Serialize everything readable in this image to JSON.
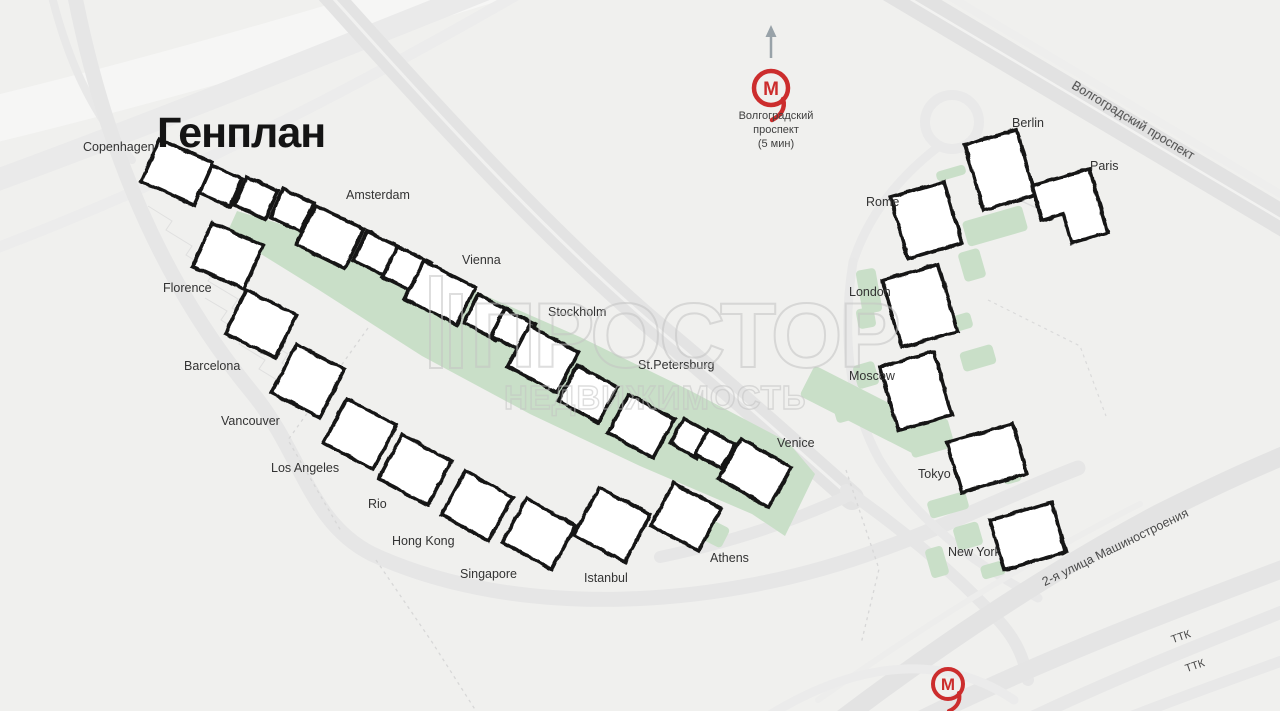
{
  "title": "Генплан",
  "watermark": {
    "line1": "ПРОСТОР",
    "line2": "НЕДВИЖИМОСТЬ"
  },
  "metro": {
    "top": {
      "caption_lines": [
        "Волгоградский",
        "проспект",
        "(5 мин)"
      ],
      "cx": 771,
      "cy": 88
    },
    "bottom": {
      "cx": 948,
      "cy": 684
    },
    "letter": "М"
  },
  "streets": [
    {
      "name": "Волгоградский проспект"
    },
    {
      "name": "2-я улица Машиностроения"
    },
    {
      "name": "ТТК"
    },
    {
      "name": "ТТК"
    }
  ],
  "colors": {
    "background": "#f0f0ee",
    "road": "#e3e3e3",
    "green": "#c9dfc8",
    "building_fill": "#ffffff",
    "building_stroke": "#151515",
    "metro_red": "#cc2d2d",
    "watermark": "#c3c3c3"
  },
  "map": {
    "courtyard_points": "237,211 355,246 468,288 580,337 689,390 788,442 815,474 785,536 752,514 640,466 530,414 422,356 319,290 227,233",
    "green_patches": [
      {
        "cx": 995,
        "cy": 226,
        "w": 62,
        "h": 26,
        "rot": -16
      },
      {
        "cx": 972,
        "cy": 265,
        "w": 22,
        "h": 30,
        "rot": -16
      },
      {
        "cx": 869,
        "cy": 291,
        "w": 20,
        "h": 44,
        "rot": -10
      },
      {
        "cx": 866,
        "cy": 318,
        "w": 18,
        "h": 20,
        "rot": -10
      },
      {
        "cx": 962,
        "cy": 322,
        "w": 20,
        "h": 16,
        "rot": -16
      },
      {
        "cx": 978,
        "cy": 358,
        "w": 34,
        "h": 20,
        "rot": -16
      },
      {
        "cx": 866,
        "cy": 375,
        "w": 22,
        "h": 24,
        "rot": -16
      },
      {
        "cx": 845,
        "cy": 406,
        "w": 24,
        "h": 30,
        "rot": -16
      },
      {
        "cx": 865,
        "cy": 410,
        "w": 130,
        "h": 34,
        "rot": 27
      },
      {
        "cx": 930,
        "cy": 438,
        "w": 44,
        "h": 30,
        "rot": -16
      },
      {
        "cx": 948,
        "cy": 505,
        "w": 40,
        "h": 18,
        "rot": -16
      },
      {
        "cx": 968,
        "cy": 536,
        "w": 26,
        "h": 24,
        "rot": -16
      },
      {
        "cx": 1012,
        "cy": 477,
        "w": 18,
        "h": 12,
        "rot": -16
      },
      {
        "cx": 937,
        "cy": 562,
        "w": 18,
        "h": 30,
        "rot": -16
      },
      {
        "cx": 993,
        "cy": 570,
        "w": 24,
        "h": 14,
        "rot": -16
      },
      {
        "cx": 893,
        "cy": 427,
        "w": 16,
        "h": 18,
        "rot": -16
      },
      {
        "cx": 951,
        "cy": 173,
        "w": 30,
        "h": 10,
        "rot": -16
      },
      {
        "cx": 597,
        "cy": 416,
        "w": 16,
        "h": 30,
        "rot": 27
      },
      {
        "cx": 686,
        "cy": 462,
        "w": 36,
        "h": 18,
        "rot": 27
      },
      {
        "cx": 714,
        "cy": 533,
        "w": 26,
        "h": 22,
        "rot": 27
      },
      {
        "cx": 352,
        "cy": 264,
        "w": 32,
        "h": 22,
        "rot": 26
      },
      {
        "cx": 588,
        "cy": 356,
        "w": 34,
        "h": 24,
        "rot": 26
      },
      {
        "cx": 700,
        "cy": 424,
        "w": 30,
        "h": 22,
        "rot": 26
      }
    ],
    "buildings": [
      {
        "label": "Copenhagen",
        "lx": 83,
        "ly": 151,
        "cx": 177,
        "cy": 172,
        "w": 58,
        "h": 46,
        "rot": 24
      },
      {
        "cx": 221,
        "cy": 186,
        "w": 33,
        "h": 30,
        "rot": 24
      },
      {
        "cx": 256,
        "cy": 198,
        "w": 34,
        "h": 31,
        "rot": 25
      },
      {
        "cx": 292,
        "cy": 210,
        "w": 34,
        "h": 31,
        "rot": 25
      },
      {
        "label": "Amsterdam",
        "lx": 346,
        "ly": 199,
        "cx": 330,
        "cy": 237,
        "w": 54,
        "h": 44,
        "rot": 26
      },
      {
        "cx": 377,
        "cy": 254,
        "w": 38,
        "h": 32,
        "rot": 26
      },
      {
        "cx": 407,
        "cy": 270,
        "w": 38,
        "h": 34,
        "rot": 26
      },
      {
        "label": "Vienna",
        "lx": 462,
        "ly": 264,
        "cx": 440,
        "cy": 293,
        "w": 58,
        "h": 42,
        "rot": 27
      },
      {
        "cx": 487,
        "cy": 317,
        "w": 36,
        "h": 32,
        "rot": 27
      },
      {
        "cx": 513,
        "cy": 330,
        "w": 34,
        "h": 30,
        "rot": 27
      },
      {
        "label": "Stockholm",
        "lx": 548,
        "ly": 316,
        "cx": 543,
        "cy": 359,
        "w": 56,
        "h": 46,
        "rot": 28
      },
      {
        "cx": 588,
        "cy": 394,
        "w": 46,
        "h": 40,
        "rot": 28
      },
      {
        "label": "St.Petersburg",
        "lx": 638,
        "ly": 369,
        "cx": 641,
        "cy": 426,
        "w": 52,
        "h": 44,
        "rot": 29
      },
      {
        "cx": 690,
        "cy": 438,
        "w": 30,
        "h": 28,
        "rot": 29
      },
      {
        "cx": 715,
        "cy": 449,
        "w": 30,
        "h": 28,
        "rot": 29
      },
      {
        "label": "Venice",
        "lx": 777,
        "ly": 447,
        "cx": 755,
        "cy": 473,
        "w": 58,
        "h": 46,
        "rot": 30
      },
      {
        "label": "Florence",
        "lx": 163,
        "ly": 292,
        "cx": 228,
        "cy": 256,
        "w": 56,
        "h": 48,
        "rot": 24
      },
      {
        "label": "Barcelona",
        "lx": 184,
        "ly": 370,
        "cx": 261,
        "cy": 324,
        "w": 56,
        "h": 48,
        "rot": 26
      },
      {
        "label": "Vancouver",
        "lx": 221,
        "ly": 425,
        "cx": 308,
        "cy": 381,
        "w": 54,
        "h": 54,
        "rot": 27
      },
      {
        "label": "Los Angeles",
        "lx": 271,
        "ly": 472,
        "cx": 360,
        "cy": 434,
        "w": 56,
        "h": 50,
        "rot": 28
      },
      {
        "label": "Rio",
        "lx": 368,
        "ly": 508,
        "cx": 415,
        "cy": 470,
        "w": 56,
        "h": 50,
        "rot": 28
      },
      {
        "label": "Hong Kong",
        "lx": 392,
        "ly": 545,
        "cx": 477,
        "cy": 506,
        "w": 54,
        "h": 50,
        "rot": 29
      },
      {
        "label": "Singapore",
        "lx": 460,
        "ly": 578,
        "cx": 539,
        "cy": 534,
        "w": 56,
        "h": 50,
        "rot": 29
      },
      {
        "label": "Istanbul",
        "lx": 584,
        "ly": 582,
        "cx": 612,
        "cy": 525,
        "w": 58,
        "h": 54,
        "rot": 28
      },
      {
        "label": "Athens",
        "lx": 710,
        "ly": 562,
        "cx": 686,
        "cy": 517,
        "w": 54,
        "h": 48,
        "rot": 28
      },
      {
        "label": "Berlin",
        "lx": 1012,
        "ly": 127,
        "cx": 1000,
        "cy": 170,
        "w": 54,
        "h": 68,
        "rot": -16
      },
      {
        "label": "Paris",
        "lx": 1090,
        "ly": 170,
        "cx": 1070,
        "cy": 209,
        "w": 60,
        "h": 66,
        "rot": -16,
        "shape": "L"
      },
      {
        "label": "Rome",
        "lx": 866,
        "ly": 206,
        "cx": 926,
        "cy": 220,
        "w": 56,
        "h": 64,
        "rot": -16
      },
      {
        "label": "London",
        "lx": 849,
        "ly": 296,
        "cx": 920,
        "cy": 306,
        "w": 58,
        "h": 70,
        "rot": -16
      },
      {
        "label": "Moscow",
        "lx": 849,
        "ly": 380,
        "cx": 916,
        "cy": 391,
        "w": 56,
        "h": 66,
        "rot": -16
      },
      {
        "label": "Tokyo",
        "lx": 918,
        "ly": 478,
        "cx": 987,
        "cy": 458,
        "w": 68,
        "h": 52,
        "rot": -16
      },
      {
        "label": "New York",
        "lx": 948,
        "ly": 556,
        "cx": 1028,
        "cy": 536,
        "w": 64,
        "h": 52,
        "rot": -16
      }
    ]
  }
}
